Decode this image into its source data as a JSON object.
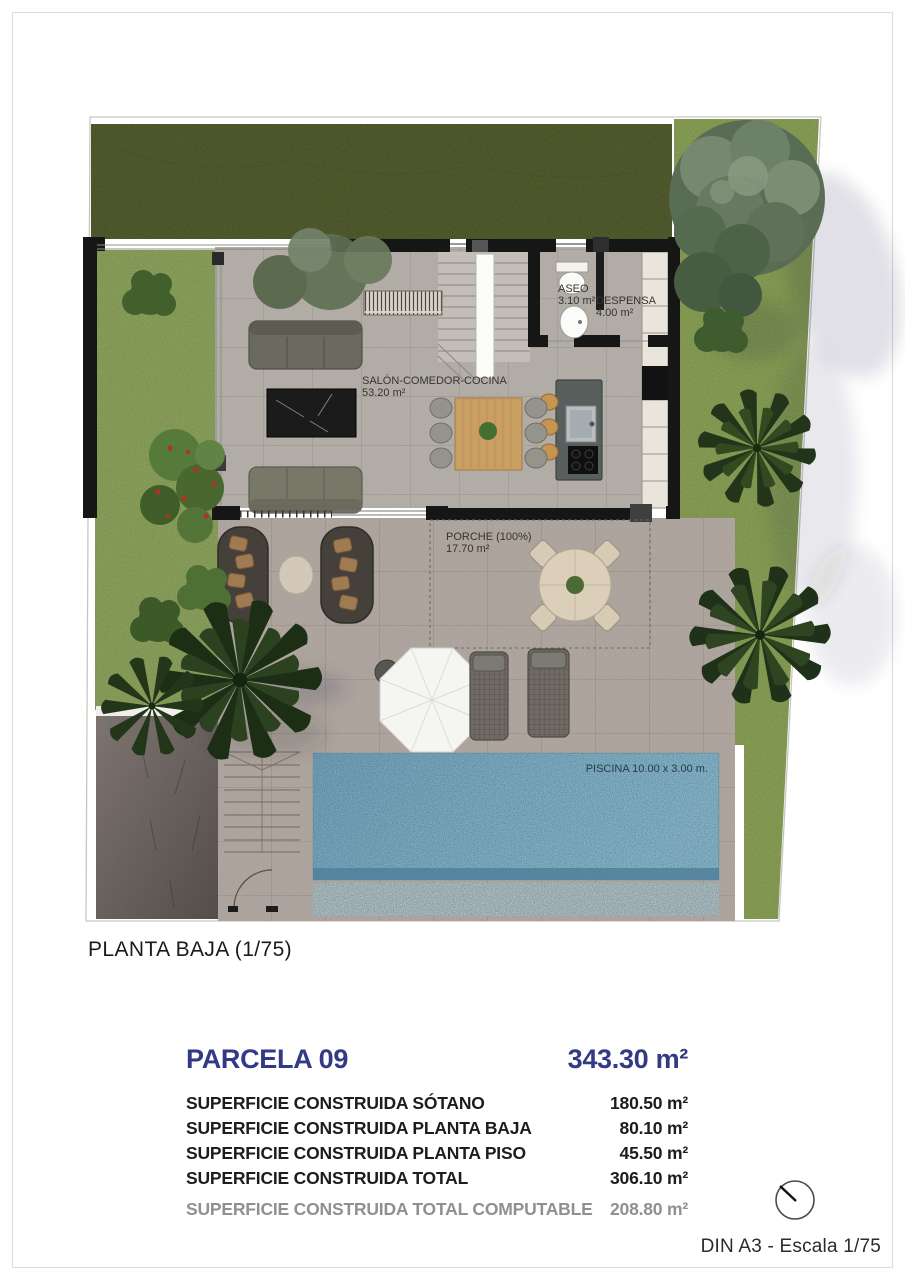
{
  "plan": {
    "title": "PLANTA BAJA (1/75)",
    "rooms": {
      "aseo": {
        "name": "ASEO",
        "area": "3.10 m²"
      },
      "despensa": {
        "name": "DESPENSA",
        "area": "4.00 m²"
      },
      "salon": {
        "name": "SALÓN-COMEDOR-COCINA",
        "area": "53.20 m²"
      },
      "porche": {
        "name": "PORCHE (100%)",
        "area": "17.70 m²"
      },
      "piscina": {
        "label": "PISCINA 10.00 x 3.00 m."
      }
    }
  },
  "summary": {
    "parcel_label": "PARCELA 09",
    "parcel_area": "343.30 m²",
    "rows": [
      {
        "label": "SUPERFICIE CONSTRUIDA SÓTANO",
        "value": "180.50 m²"
      },
      {
        "label": "SUPERFICIE CONSTRUIDA PLANTA BAJA",
        "value": "80.10 m²"
      },
      {
        "label": "SUPERFICIE CONSTRUIDA PLANTA PISO",
        "value": "45.50 m²"
      },
      {
        "label": "SUPERFICIE CONSTRUIDA TOTAL",
        "value": "306.10 m²"
      },
      {
        "label": "SUPERFICIE CONSTRUIDA TOTAL COMPUTABLE",
        "value": "208.80 m²"
      }
    ],
    "accent_color": "#323a85",
    "muted_color": "#909094"
  },
  "footer": {
    "sheet_scale": "DIN A3 - Escala 1/75"
  },
  "icons": {
    "compass": "north-indicator"
  },
  "colors": {
    "lawn_dark": "#566130",
    "lawn_light": "#8ea55e",
    "pool_water": "#7fb3cc",
    "wall": "#161616",
    "tile_interior": "#b7b1ab",
    "tile_terrace": "#b2a9a2",
    "driveway": "#6b625e"
  }
}
